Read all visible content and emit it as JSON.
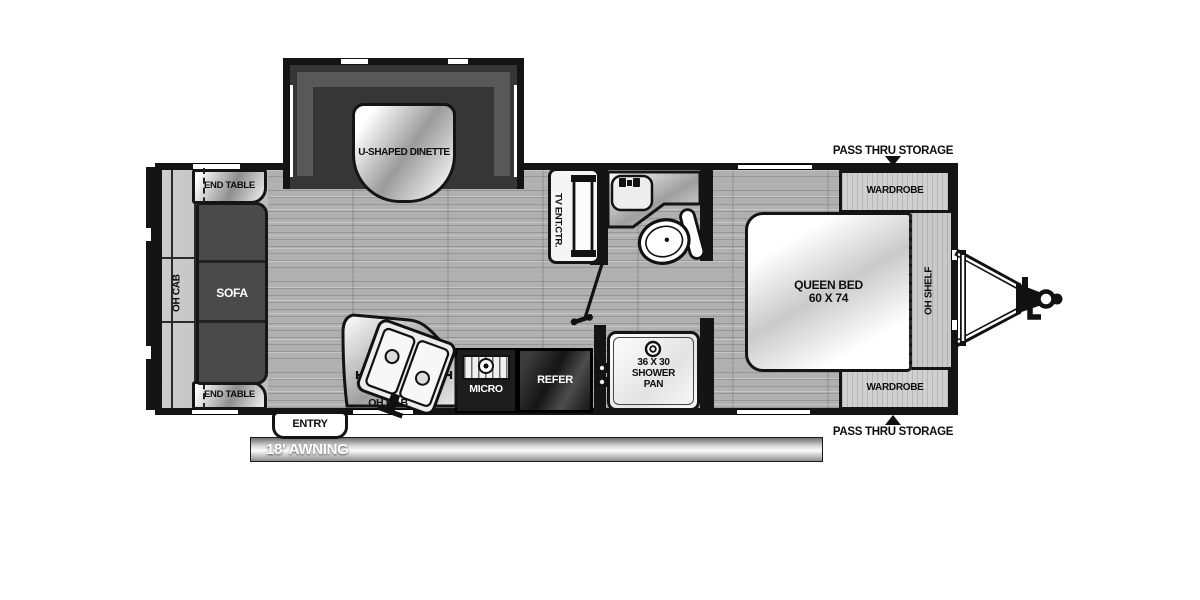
{
  "colors": {
    "wall": "#141414",
    "floor": "#b0b0b0",
    "slide_interior": "#363636",
    "sofa": "#4a4a4a",
    "appliance_dark": "#1d1d1d",
    "fixture_light": "#f5f5f5"
  },
  "slideouts": {
    "dinette": {
      "label": "U-SHAPED DINETTE"
    },
    "sofa_slide": {
      "end_table_top": "END TABLE",
      "end_table_bottom": "END TABLE",
      "oh_cab": "OH CAB",
      "sofa": "SOFA"
    }
  },
  "living": {
    "tv_center": "TV ENT.CTR."
  },
  "kitchen": {
    "oh_cab": "OH CAB",
    "micro": "MICRO",
    "refer": "REFER"
  },
  "bathroom": {
    "shower": [
      "36 X 30",
      "SHOWER",
      "PAN"
    ]
  },
  "bedroom": {
    "bed": [
      "QUEEN BED",
      "60 X 74"
    ],
    "wardrobe_top": "WARDROBE",
    "wardrobe_bottom": "WARDROBE",
    "oh_shelf": "OH SHELF",
    "pass_thru_top": "PASS THRU STORAGE",
    "pass_thru_bottom": "PASS THRU STORAGE"
  },
  "exterior": {
    "entry": "ENTRY",
    "awning": "18' AWNING"
  }
}
